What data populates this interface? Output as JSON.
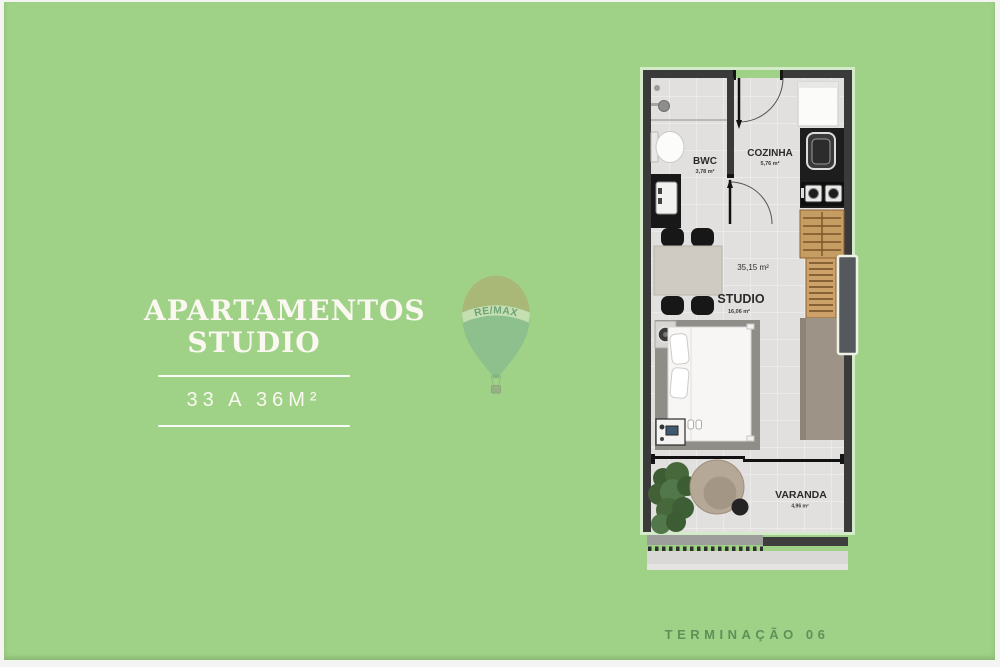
{
  "colors": {
    "background": "#9fd287",
    "text_white": "#faf8f1",
    "footer_green": "#5d9158",
    "wall_dark": "#3a3a3a",
    "floor": "#e1e0de",
    "wood": "#c59c62",
    "balloon_top": "#b3a269",
    "balloon_band": "#e6ebd8",
    "balloon_body": "#7fb093",
    "balloon_text": "#44756a"
  },
  "left_panel": {
    "title_line1": "APARTAMENTOS",
    "title_line2": "STUDIO",
    "subtitle": "33 A 36M²"
  },
  "watermark": {
    "brand": "RE/MAX"
  },
  "floorplan": {
    "rooms": [
      {
        "name": "BWC",
        "area": "3,78 m²"
      },
      {
        "name": "COZINHA",
        "area": "5,76 m²"
      },
      {
        "name": "STUDIO",
        "area": "16,06 m²"
      },
      {
        "name": "VARANDA",
        "area": "4,96 m²"
      }
    ],
    "total_area": "35,15 m²"
  },
  "footer": {
    "label": "TERMINAÇÃO 06"
  }
}
